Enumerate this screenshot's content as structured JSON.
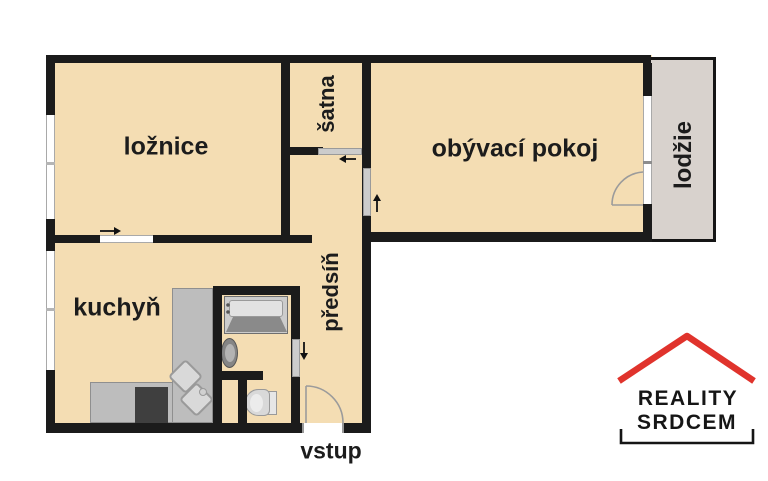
{
  "floorplan": {
    "rooms": {
      "bedroom": "ložnice",
      "closet": "šatna",
      "living_room": "obývací pokoj",
      "loggia": "lodžie",
      "kitchen": "kuchyň",
      "hallway": "předsíň"
    },
    "entrance_label": "vstup"
  },
  "logo": {
    "line1": "REALITY",
    "line2": "SRDCEM"
  },
  "icons": {
    "arrow_right": "→",
    "arrow_left": "←",
    "arrow_up": "↑",
    "arrow_down": "↓",
    "roof": "^"
  },
  "colors": {
    "room_fill": "#f4ddb3",
    "loggia_fill": "#d8d2cd",
    "wall": "#1b1b1b",
    "door_gray": "#cccccc",
    "logo_red": "#e0332c"
  }
}
